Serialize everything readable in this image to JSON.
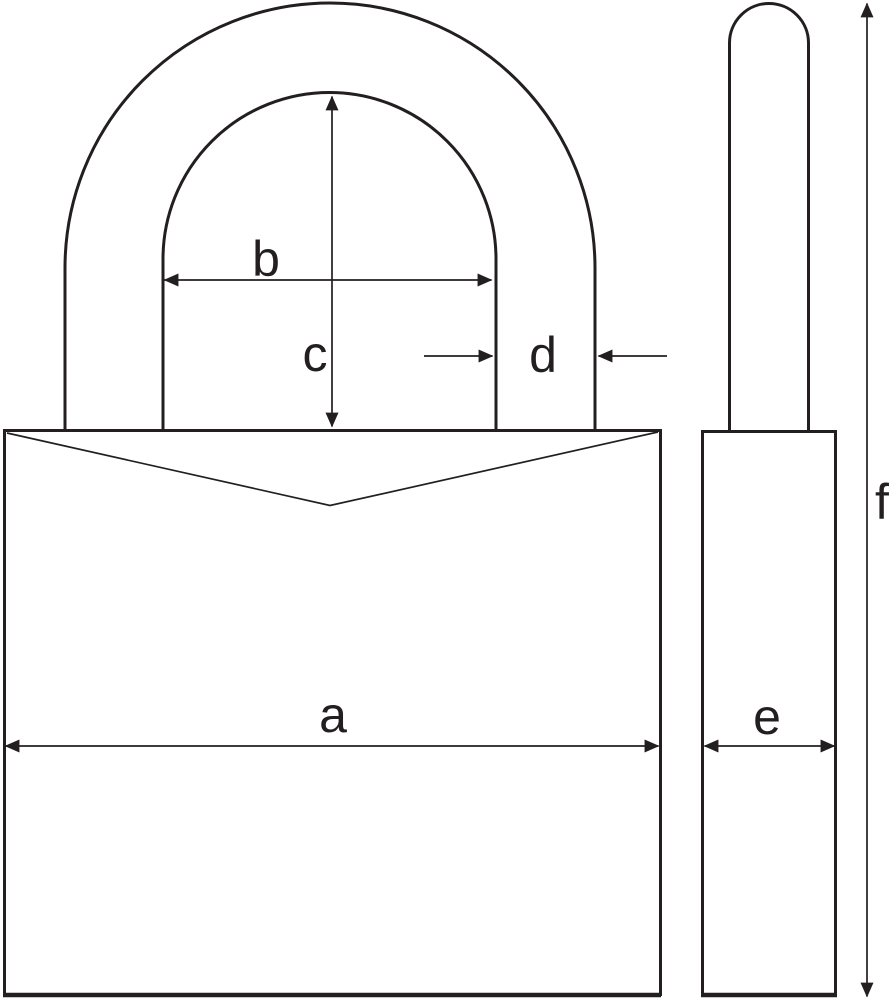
{
  "diagram": {
    "subject": "padlock-dimension-drawing",
    "colors": {
      "background": "#ffffff",
      "line": "#231f20"
    },
    "dimension_labels": {
      "a": "a",
      "b": "b",
      "c": "c",
      "d": "d",
      "e": "e",
      "f": "f"
    }
  }
}
